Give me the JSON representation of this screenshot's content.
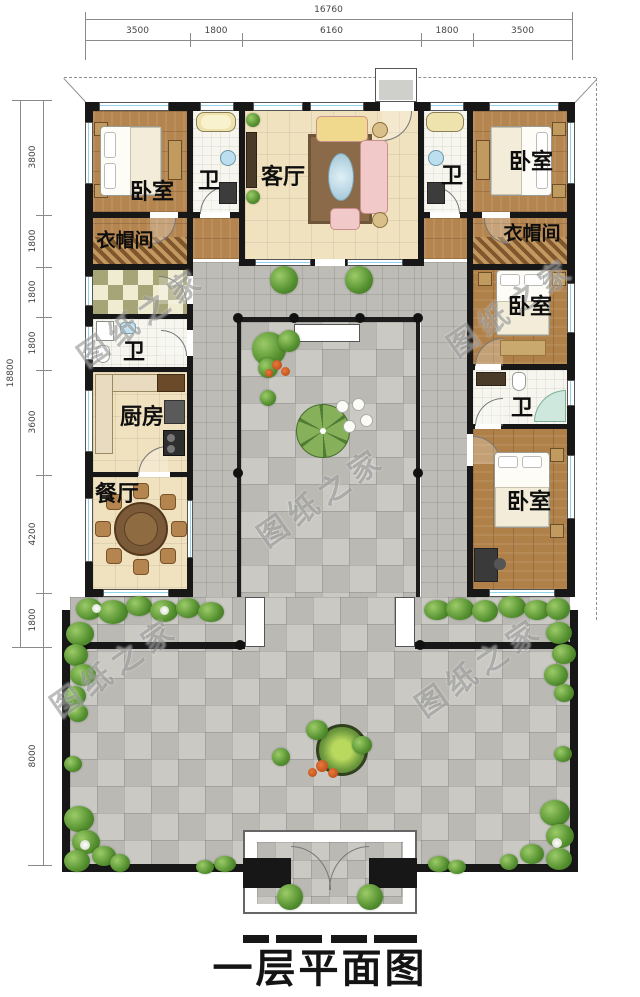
{
  "title": "一层平面图",
  "watermark_text": "图纸之家",
  "dimensions": {
    "top": {
      "total": "16760",
      "segments": [
        "3500",
        "1800",
        "6160",
        "1800",
        "3500"
      ]
    },
    "left": {
      "total": "18800",
      "segments": [
        "3800",
        "1800",
        "1800",
        "1800",
        "3600",
        "4200",
        "1800",
        "8000"
      ]
    }
  },
  "rooms": {
    "bedroom_top_left": "卧室",
    "bath_top_left": "卫",
    "living_room": "客厅",
    "bath_top_right": "卫",
    "bedroom_top_right": "卧室",
    "cloakroom_left": "衣帽间",
    "cloakroom_right": "衣帽间",
    "bedroom_right_middle": "卧室",
    "bath_right_wing": "卫",
    "bedroom_right_bottom": "卧室",
    "bath_left_wing": "卫",
    "kitchen": "厨房",
    "dining_room": "餐厅"
  },
  "colors": {
    "wall": "#171717",
    "wood_floor": "#b5854f",
    "cream_floor": "#f1e2bf",
    "paving": "#c4c3bd",
    "greenery": "#54902f",
    "window_glass": "#8fd4ea"
  }
}
